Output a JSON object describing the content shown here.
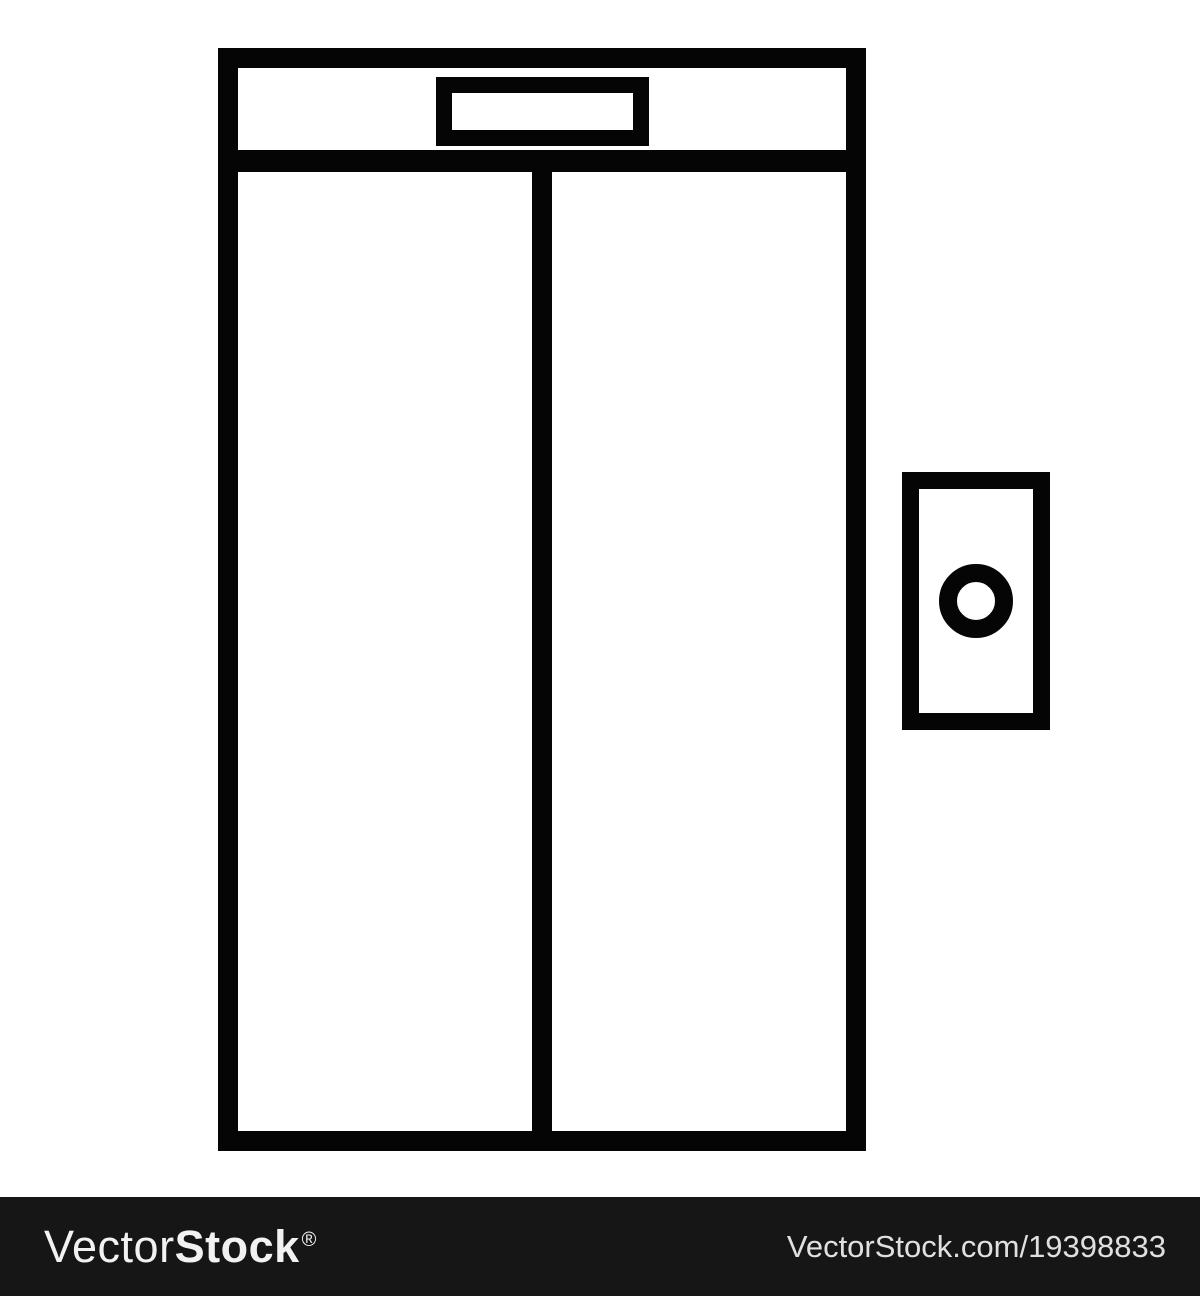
{
  "illustration": {
    "subject": "elevator-with-closed-doors-and-call-button",
    "colors": {
      "line": "#050505",
      "background": "#ffffff",
      "door_fill": "#ffffff"
    }
  },
  "watermark": {
    "bar_color": "#161616",
    "text_color": "#f2f2f2",
    "logo": {
      "vector": "Vector",
      "stock": "Stock",
      "registered": "®"
    },
    "credit": "VectorStock.com/19398833"
  }
}
